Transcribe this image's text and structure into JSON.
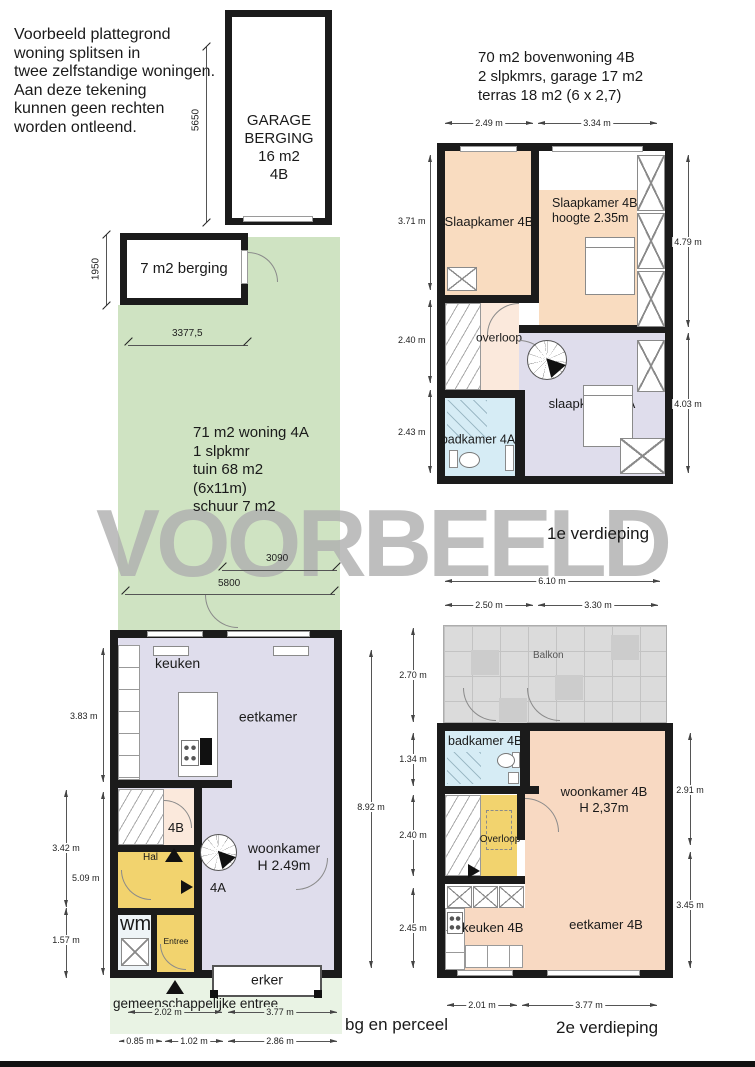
{
  "watermark": "VOORBEELD",
  "notes": {
    "disclaimer": "Voorbeeld plattegrond\nwoning splitsen in\ntwee zelfstandige woningen.\nAan deze tekening\nkunnen geen rechten\nworden ontleend.",
    "unit4b_header": "70 m2 bovenwoning 4B\n2 slpkmrs, garage 17 m2\nterras 18 m2 (6 x 2,7)",
    "unit4a_info": "71 m2 woning 4A\n1 slpkmr\ntuin 68 m2\n(6x11m)\nschuur 7 m2",
    "common_entrance": "gemeenschappelijke entree"
  },
  "floor_labels": {
    "first": "1e verdieping",
    "second": "2e verdieping",
    "ground": "bg en perceel"
  },
  "garage": {
    "label": "GARAGE\nBERGING\n16 m2\n4B",
    "height_mm": "5650"
  },
  "berging": {
    "label": "7 m2 berging",
    "height_mm": "1950",
    "width_mm": "3377,5"
  },
  "garden": {
    "dim_upper": "3090",
    "dim_lower": "5800"
  },
  "ground_floor": {
    "rooms": {
      "keuken": "keuken",
      "eetkamer": "eetkamer",
      "stair": "4B",
      "hal": "Hal",
      "woonkamer": "woonkamer\nH 2.49m",
      "door": "4A",
      "wm": "wm",
      "entree": "Entree",
      "erker": "erker"
    },
    "dims": {
      "left_inner_top": "3.83 m",
      "left_inner_bottom": "5.09 m",
      "left_outer_top": "3.42 m",
      "left_outer_bottom": "1.57 m",
      "right": "8.92 m",
      "bottom_row1": [
        "2.02 m",
        "3.77 m"
      ],
      "bottom_row2": [
        "0.85 m",
        "1.02 m",
        "2.86 m"
      ]
    }
  },
  "first_floor": {
    "rooms": {
      "slaapkamer_b_left": "Slaapkamer 4B",
      "slaapkamer_b_right": "Slaapkamer 4B\nhoogte 2.35m",
      "overloop": "overloop",
      "badkamer": "badkamer 4A",
      "slaapkamer_a": "slaapkamer 4A"
    },
    "dims": {
      "top": [
        "2.49 m",
        "3.34 m"
      ],
      "left": [
        "3.71 m",
        "2.40 m",
        "2.43 m"
      ],
      "right": [
        "4.79 m",
        "4.03 m"
      ],
      "bottom": "6.10 m"
    }
  },
  "second_floor": {
    "rooms": {
      "balkon": "Balkon",
      "badkamer": "badkamer 4B",
      "woonkamer": "woonkamer 4B\nH 2,37m",
      "overloop": "Overloop",
      "keuken": "keuken 4B",
      "eetkamer": "eetkamer 4B"
    },
    "dims": {
      "top": [
        "2.50 m",
        "3.30 m"
      ],
      "left": [
        "2.70 m",
        "1.34 m",
        "2.40 m",
        "2.45 m"
      ],
      "right": [
        "2.91 m",
        "3.45 m"
      ],
      "bottom": [
        "2.01 m",
        "3.77 m"
      ]
    }
  },
  "colors": {
    "wall": "#1b1b1b",
    "garden": "#cfe3c2",
    "plot_light": "#e9f3e4",
    "bedroom_orange": "#f9dcc0",
    "lavender": "#dfddec",
    "bath_blue": "#d6ecf5",
    "hall_yellow": "#f2d36e",
    "landing_pink": "#fbe9dc",
    "living_peach": "#f8d9c2",
    "balkon_gray": "#dbdbdb",
    "watermark": "#b0b0b0"
  }
}
